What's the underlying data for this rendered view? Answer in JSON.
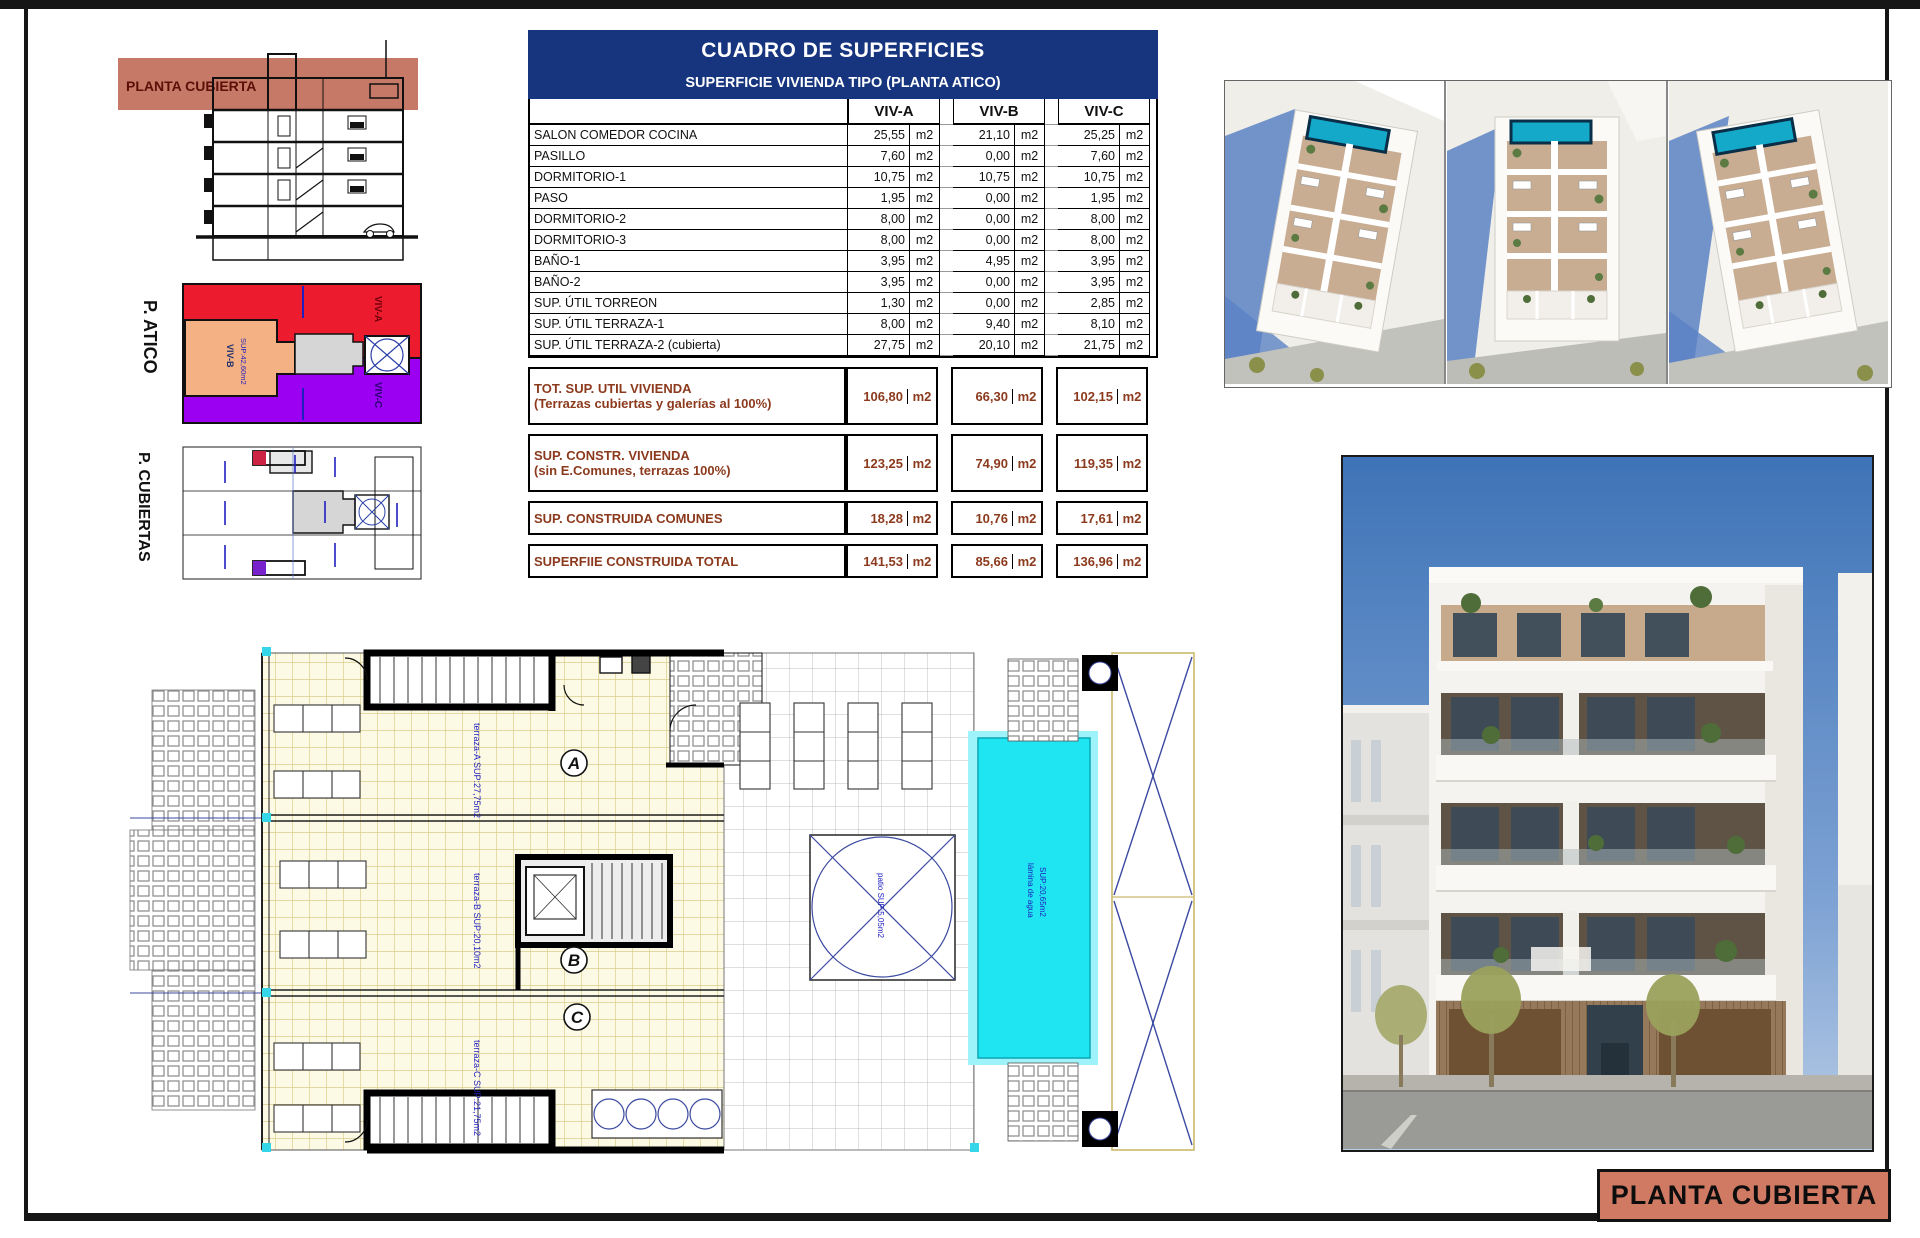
{
  "sheet": {
    "title_block_label": "PLANTA CUBIERTA",
    "section_band_label": "PLANTA CUBIERTA",
    "atico_side_label": "P. ATICO",
    "cubiertas_side_label": "P. CUBIERTAS"
  },
  "atico_plan": {
    "viv_a": "VIV-A",
    "viv_b": "VIV-B",
    "viv_b_sup": "SUP:42,60m2",
    "viv_c": "VIV-C"
  },
  "table": {
    "title": "CUADRO DE SUPERFICIES",
    "subtitle": "SUPERFICIE VIVIENDA TIPO (PLANTA ATICO)",
    "unit": "m2",
    "columns": [
      "VIV-A",
      "VIV-B",
      "VIV-C"
    ],
    "rows": [
      {
        "label": "SALON COMEDOR COCINA",
        "a": "25,55",
        "b": "21,10",
        "c": "25,25"
      },
      {
        "label": "PASILLO",
        "a": "7,60",
        "b": "0,00",
        "c": "7,60"
      },
      {
        "label": "DORMITORIO-1",
        "a": "10,75",
        "b": "10,75",
        "c": "10,75"
      },
      {
        "label": "PASO",
        "a": "1,95",
        "b": "0,00",
        "c": "1,95"
      },
      {
        "label": "DORMITORIO-2",
        "a": "8,00",
        "b": "0,00",
        "c": "8,00"
      },
      {
        "label": "DORMITORIO-3",
        "a": "8,00",
        "b": "0,00",
        "c": "8,00"
      },
      {
        "label": "BAÑO-1",
        "a": "3,95",
        "b": "4,95",
        "c": "3,95"
      },
      {
        "label": "BAÑO-2",
        "a": "3,95",
        "b": "0,00",
        "c": "3,95"
      },
      {
        "label": "SUP. ÚTIL TORREON",
        "a": "1,30",
        "b": "0,00",
        "c": "2,85"
      },
      {
        "label": "SUP. ÚTIL TERRAZA-1",
        "a": "8,00",
        "b": "9,40",
        "c": "8,10"
      },
      {
        "label": "SUP. ÚTIL TERRAZA-2 (cubierta)",
        "a": "27,75",
        "b": "20,10",
        "c": "21,75"
      }
    ],
    "summary": [
      {
        "label": "TOT. SUP. UTIL VIVIENDA",
        "sublabel": "(Terrazas cubiertas y galerías al 100%)",
        "a": "106,80",
        "b": "66,30",
        "c": "102,15"
      },
      {
        "label": "SUP. CONSTR. VIVIENDA",
        "sublabel": "(sin E.Comunes, terrazas 100%)",
        "a": "123,25",
        "b": "74,90",
        "c": "119,35"
      },
      {
        "label": "SUP. CONSTRUIDA COMUNES",
        "sublabel": "",
        "a": "18,28",
        "b": "10,76",
        "c": "17,61"
      },
      {
        "label": "SUPERFIIE CONSTRUIDA TOTAL",
        "sublabel": "",
        "a": "141,53",
        "b": "85,66",
        "c": "136,96"
      }
    ]
  },
  "floor_plan": {
    "letter_a": "A",
    "letter_b": "B",
    "letter_c": "C",
    "terraza_a": "terraza-A SUP:27,75m2",
    "terraza_b": "terraza-B SUP:20,10m2",
    "terraza_c": "terraza-C SUP:21,75m2",
    "patio_label": "patio SUP:5,05m2",
    "pool_label_1": "lámina de agua",
    "pool_label_2": "SUP:20,65m2"
  },
  "colors": {
    "navy_header": "#17357E",
    "salmon_band": "#C4725F",
    "title_block_bg": "#D07A64",
    "summary_brown": "#8C3A1D",
    "annotation_blue": "#1F1FBF",
    "pool_cyan": "#1FE5F2",
    "atico_red": "#EC1C2E",
    "atico_orange": "#F4B183",
    "atico_purple": "#9B00F2",
    "render_sky": "#3E73B7"
  }
}
